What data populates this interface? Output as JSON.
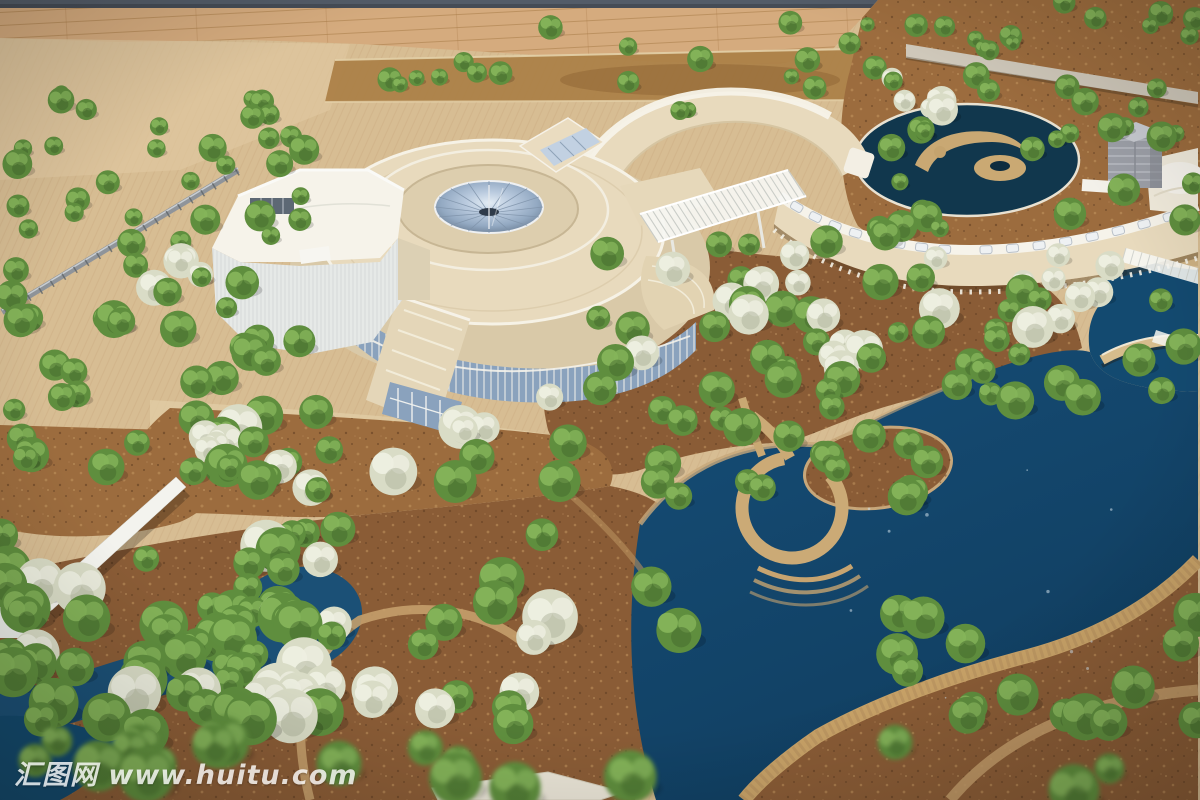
{
  "meta": {
    "type": "photograph",
    "subject": "Aerial photograph of an architectural scale model of a cultural campus: a circular museum building with a glass funnel skylight, two crescent-shaped wing buildings linked by white trellis skybridges, a large blue lake with an island and arched bridge, winding streams, tan plazas and hundreds of miniature trees",
    "setting": "model table displayed indoors, wooden floor visible along the top edge"
  },
  "watermark": {
    "site_name": "汇图网",
    "url": "www.huitu.com",
    "full_text": "汇图网 www.huitu.com"
  },
  "scene_labels": {
    "main_building": "circular museum hall with glass cone skylight",
    "north_building": "crescent exhibition wing",
    "east_building": "long curved gallery wing with skylight band",
    "annex": "white ribbed annex hall",
    "lake": "landscape lake with island and ring promenade",
    "pond": "circular swirl pond",
    "bridge": "arched footbridge",
    "skybridge": "white trellis skywalk",
    "trees_green": "green model trees",
    "trees_blossom": "white flowering model trees"
  },
  "palette": {
    "backdrop": "#454c56",
    "wood": "#cfa375",
    "wood_line": "#b2805022",
    "plaza": "#d7bd93",
    "plaza_stripe": "#c3a277",
    "dirt": "#8a5c36",
    "dirt_light": "#9c6c3e",
    "lake": "#164d76",
    "lake_deep": "#103e60",
    "stream": "#1b5076",
    "pond": "#11374d",
    "path_tan": "#cbaa76",
    "sand": "#c7a77a",
    "building_cream": "#e8dabd",
    "building_cream_dark": "#d9c9a8",
    "building_white": "#f6f3ea",
    "annex_white": "#e6e9e7",
    "glass": "#8aa2bd",
    "glass_light": "#c2d1e2",
    "cube_gray": "#9da0a8",
    "fence_gray": "#8f949a",
    "wall_white": "#f3f3ee",
    "tree_green": "#5f8e3e",
    "tree_green_light": "#85b45a",
    "tree_green_dark": "#41632a",
    "tree_blossom": "#d9dcc6",
    "tree_blossom_light": "#eeefe1",
    "trunk": "#2e2419"
  }
}
